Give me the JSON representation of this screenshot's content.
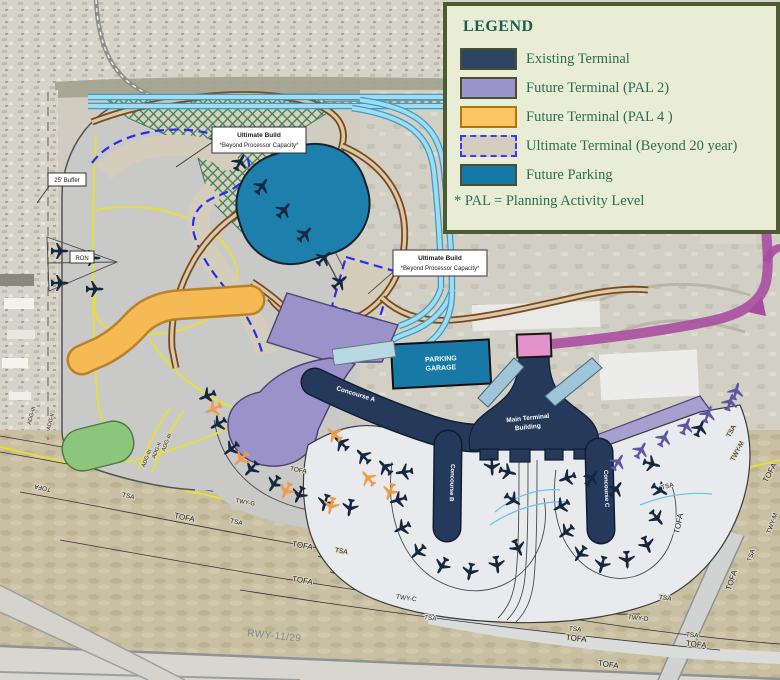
{
  "legend": {
    "title": "LEGEND",
    "items": [
      {
        "label": "Existing Terminal",
        "swatch": "existing-terminal",
        "color": "#2c4563"
      },
      {
        "label": "Future Terminal (PAL 2)",
        "swatch": "future-terminal-pal2",
        "color": "#9a94cb"
      },
      {
        "label": "Future Terminal (PAL 4 )",
        "swatch": "future-terminal-pal4",
        "color": "#fbc566"
      },
      {
        "label": "Ultimate Terminal (Beyond 20 year)",
        "swatch": "ultimate-terminal",
        "color": "#d5cdbd",
        "border": "#3a3af0 dashed"
      },
      {
        "label": "Future Parking",
        "swatch": "future-parking",
        "color": "#1478a6"
      }
    ],
    "footnote": "* PAL = Planning Activity Level"
  },
  "map": {
    "labels": {
      "ultimate_build_title": "Ultimate Build",
      "ultimate_build_sub": "*Beyond Processor Capacity*",
      "buffer": "25' Buffer",
      "ron": "RON",
      "parking_line1": "PARKING",
      "parking_line2": "GARAGE",
      "terminal_line1": "Main Terminal",
      "terminal_line2": "Building",
      "concourse_a": "Concourse A",
      "concourse_b": "Concourse B",
      "concourse_c": "Concourse C",
      "runway": "RWY-11/29",
      "twy_c": "TWY-C",
      "twy_d": "TWY-D",
      "twy_g": "TWY-G",
      "twy_m": "TWY-M",
      "tofa": "TOFA",
      "tsa": "TSA",
      "adg2": "ADG-II",
      "adg3": "ADG-III"
    },
    "colors": {
      "existing_terminal": "#2c4563",
      "future_terminal_pal2": "#9a94cb",
      "future_terminal_pal4": "#fbc566",
      "ultimate_terminal_tan": "#d5cdbd",
      "ultimate_dash_blue": "#2a2af0",
      "future_parking": "#1478a6",
      "magenta_route": "#a84ba0",
      "pink_station": "#e391c9",
      "cyan_road": "#9fdcf4",
      "brown_road": "#7a4a1e",
      "yellow_taxiline": "#e8e030",
      "legend_bg": "#e9edd6",
      "legend_border": "#4e5a34",
      "legend_text": "#2a6e52"
    }
  }
}
